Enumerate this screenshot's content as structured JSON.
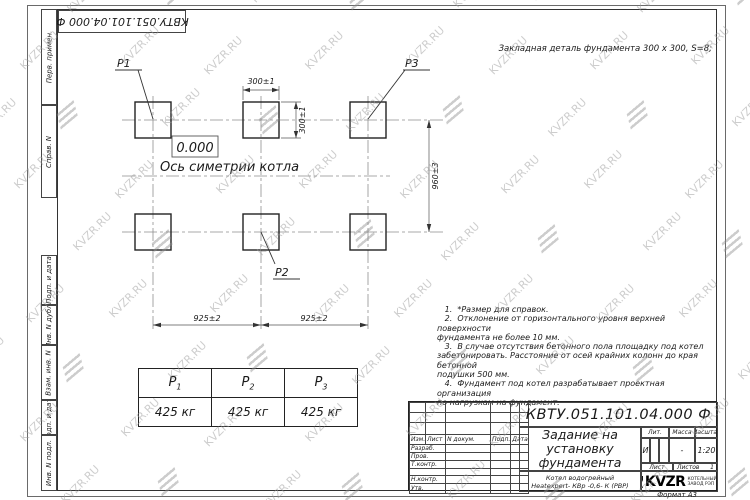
{
  "watermark": {
    "text": "KVZR.RU"
  },
  "frame": {
    "doc_number_rotated": "КВТУ.051.101.04.000  Ф",
    "margin_labels": {
      "perv_primen": "Перв. примен.",
      "sprav_n": "Справ. N",
      "podp_data_1": "Подп. и дата",
      "inv_n_dubl": "Инв. N дубл.",
      "vzam_inv_n": "Взам. инв. N",
      "podp_data_2": "Подп. и дата",
      "inv_n_podl": "Инв. N подл."
    },
    "format_label": "Формат А3"
  },
  "drawing": {
    "detail_note": "Закладная деталь фундамента  300 x 300, S=8;",
    "labels": {
      "p1": "P1",
      "p2": "P2",
      "p3": "P3"
    },
    "elevation_mark": "0.000",
    "axis_label": "Ось симетрии котла",
    "dims": {
      "top_width": "300±1",
      "side_height": "300±1",
      "row_spacing": "960±3",
      "col_spacing_left": "925±2",
      "col_spacing_right": "925±2"
    }
  },
  "loads_table": {
    "headers": [
      {
        "base": "P",
        "sub": "1"
      },
      {
        "base": "P",
        "sub": "2"
      },
      {
        "base": "P",
        "sub": "3"
      }
    ],
    "values": [
      "425 кг",
      "425 кг",
      "425 кг"
    ]
  },
  "notes_text": "   1.  *Размер для справок.\n   2.  Отклонение от горизонтального уровня верхней поверхности\nфундамента не более 10 мм.\n   3.  В случае отсутствия бетонного пола площадку под котел\nзабетонировать. Расстояние от осей крайних колонн до края бетонной\nподушки 500 мм.\n   4.  Фундамент под котел разрабатывает проектная организация\nпо нагрузкам на фундамент.",
  "title_block": {
    "doc_number": "КВТУ.051.101.04.000  Ф",
    "title_lines": [
      "Задание на",
      "установку",
      "фундамента"
    ],
    "product_lines": [
      "Котел водогрейный",
      "Heatexpert- КВр -0,6- К (РВР)"
    ],
    "change_table": {
      "izm": "Изм.",
      "list": "Лист",
      "n_dokum": "N докум.",
      "podp": "Подп.",
      "data": "Дата"
    },
    "sign_rows": {
      "razrab": "Разраб.",
      "prov": "Пров.",
      "t_kontr": "Т.контр.",
      "n_kontr": "Н.контр.",
      "utv": "Утв."
    },
    "lit_header": "Лит.",
    "mass_header": "Масса",
    "scale_header": "Масштаб",
    "lit_value": "И",
    "mass_value": "-",
    "scale_value": "1:20",
    "sheet_label": "Лист",
    "sheets_label": "Листов",
    "sheets_value": "1",
    "logo_text": "KVZR",
    "company_lines": [
      "КОТЕЛЬНЫЙ",
      "ЗАВОД РЭП"
    ]
  }
}
